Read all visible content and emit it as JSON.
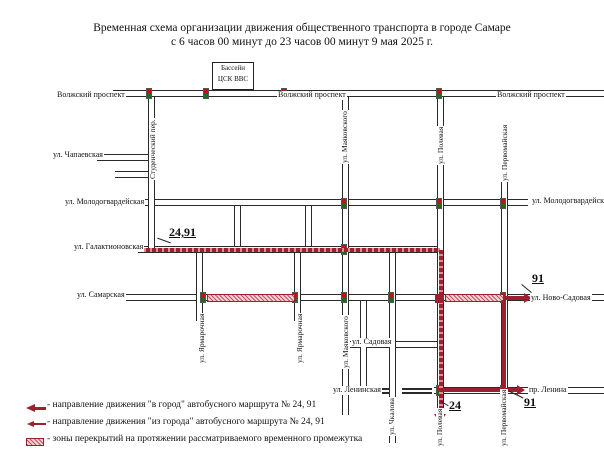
{
  "title": {
    "line1": "Временная схема организации движения общественного транспорта в городе Самаре",
    "line2": "с 6 часов 00 минут  до 23 часов 00 минут 9 мая 2025 г."
  },
  "landmark": {
    "pool_line1": "Бассейн",
    "pool_line2": "ЦСК ВВС"
  },
  "streets": {
    "volzhsky_prospekt": "Волжский проспект",
    "chapaevskaya": "ул. Чапаевская",
    "molodogvardeyskaya": "ул. Молодогвардейская",
    "galaktionovskaya": "ул. Галактионовская",
    "samarskaya": "ул. Самарская",
    "novo_sadovaya": "ул. Ново-Садовая",
    "sadovaya": "ул. Садовая",
    "leninskaya": "ул. Ленинская",
    "pr_lenina": "пр. Ленина",
    "studencheskiy_per": "Студенческий пер.",
    "mayakovskogo": "ул. Маяковского",
    "yarmarochnaya": "ул. Ярмарочная",
    "chkalova": "ул. Чкалова",
    "polevaya": "ул. Полевая",
    "pervomayskaya": "ул. Первомайская"
  },
  "annotations": {
    "routes_24_91": "24,91",
    "route_91": "91",
    "route_24": "24"
  },
  "legend": {
    "items": [
      {
        "text": "- направление движения \"в город\" автобусного маршрута № 24, 91"
      },
      {
        "text": "- направление движения \"из города\" автобусного маршрута № 24, 91"
      },
      {
        "text": "- зоны перекрытий на протяжении рассматриваемого временного промежутка"
      }
    ]
  },
  "colors": {
    "route": "#9e1f2e",
    "closure_fill": "#f0d6d9",
    "road_line": "#2a2a2a"
  }
}
